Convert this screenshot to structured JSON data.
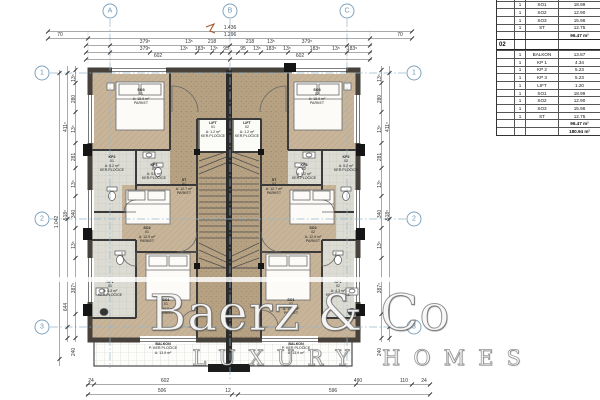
{
  "brand": {
    "name": "Baerz & Co",
    "tagline": "LUXURY HOMES"
  },
  "grid_bubbles": {
    "top": [
      "A",
      "B",
      "C"
    ],
    "left": [
      "1",
      "2",
      "3"
    ],
    "right": [
      "1",
      "2",
      "3"
    ]
  },
  "dimensions": {
    "top_total": "1.436",
    "top_row2": [
      "70",
      "1.296",
      "70"
    ],
    "top_row3": [
      "379⁵",
      "13⁵",
      "218",
      "218",
      "13⁵",
      "379⁵"
    ],
    "top_row4": [
      "379⁵",
      "13⁵",
      "183⁵",
      "13⁵",
      "95",
      "95",
      "13⁵",
      "183⁵",
      "13⁵",
      "183⁵",
      "13⁵",
      "183⁵"
    ],
    "top_row5": [
      "602",
      "602"
    ],
    "left_total": "1.042",
    "left_mid": [
      "411⁵",
      "518⁵",
      "644"
    ],
    "left_segments": [
      "13⁵",
      "280",
      "13⁵",
      "281",
      "13⁵",
      "340",
      "13⁵",
      "387⁵",
      "240"
    ],
    "right_mid": [
      "411⁵",
      "518⁵",
      "644"
    ],
    "right_segments": [
      "13⁵",
      "280",
      "13⁵",
      "281",
      "13⁵",
      "340",
      "13⁵",
      "387⁵",
      "240"
    ],
    "bottom_row1": [
      "24",
      "602",
      "490",
      "110",
      "24"
    ],
    "bottom_row2": [
      "506",
      "12",
      "596"
    ]
  },
  "rooms": {
    "so3_l": {
      "name": "SO3",
      "num": "01",
      "area": "A: 15.9 m²",
      "floor": "PARKET"
    },
    "so3_r": {
      "name": "SO3",
      "num": "02",
      "area": "A: 15.9 m²",
      "floor": "PARKET"
    },
    "kp2_l": {
      "name": "KP2",
      "num": "01",
      "area": "A: 5.2 m²",
      "floor": "KER.PLOČICE"
    },
    "kp2_r": {
      "name": "KP2",
      "num": "02",
      "area": "A: 5.2 m²",
      "floor": "KER.PLOČICE"
    },
    "kp3_l": {
      "name": "KP3",
      "num": "01",
      "area": "A: 5.2 m²",
      "floor": "KER.PLOČICE"
    },
    "kp3_r": {
      "name": "KP3",
      "num": "02",
      "area": "A: 5.2 m²",
      "floor": "KER.PLOČICE"
    },
    "so2_l": {
      "name": "SO2",
      "num": "01",
      "area": "A: 12.9 m²",
      "floor": "PARKET"
    },
    "so2_r": {
      "name": "SO2",
      "num": "02",
      "area": "A: 12.9 m²",
      "floor": "PARKET"
    },
    "st_l": {
      "name": "ST",
      "num": "01",
      "area": "A: 12.7 m²",
      "floor": "PARKET"
    },
    "st_r": {
      "name": "ST",
      "num": "02",
      "area": "A: 12.7 m²",
      "floor": "PARKET"
    },
    "lift_l": {
      "name": "LIFT",
      "num": "01",
      "area": "A: 1.2 m²",
      "floor": "KER.PLOČICE"
    },
    "lift_r": {
      "name": "LIFT",
      "num": "02",
      "area": "A: 1.2 m²",
      "floor": "KER.PLOČICE"
    },
    "kp1_l": {
      "name": "KP1",
      "num": "01",
      "area": "A: 4.3 m²",
      "floor": "KER.PLOČICE"
    },
    "kp1_r": {
      "name": "KP1",
      "num": "02",
      "area": "A: 4.3 m²",
      "floor": "KER.PLOČICE"
    },
    "so1_l": {
      "name": "SO1",
      "num": "01",
      "area": "A: 19.0 m²",
      "floor": "PARKET"
    },
    "so1_r": {
      "name": "SO1",
      "num": "02",
      "area": "A: 19.0 m²",
      "floor": "PARKET"
    },
    "balkon_l": {
      "name": "BALKON",
      "floor": "P: KER PLOČICE",
      "area": "A: 13.9 m²"
    },
    "balkon_r": {
      "name": "BALKON",
      "floor": "P: KER PLOČICE",
      "area": "A: 13.9 m²"
    }
  },
  "schedule": {
    "rows_01": [
      {
        "qty": "1",
        "name": "LIFT",
        "area": "1.20"
      },
      {
        "qty": "1",
        "name": "SO1",
        "area": "18.99"
      },
      {
        "qty": "1",
        "name": "SO2",
        "area": "12.90"
      },
      {
        "qty": "1",
        "name": "SO3",
        "area": "15.96"
      },
      {
        "qty": "1",
        "name": "ST",
        "area": "12.75"
      }
    ],
    "total_01": "96.47 m²",
    "section_label": "02",
    "rows_02": [
      {
        "qty": "1",
        "name": "BALKON",
        "area": "13.87"
      },
      {
        "qty": "1",
        "name": "KP 1",
        "area": "4.34"
      },
      {
        "qty": "1",
        "name": "KP 2",
        "area": "5.23"
      },
      {
        "qty": "1",
        "name": "KP 3",
        "area": "5.23"
      },
      {
        "qty": "1",
        "name": "LIFT",
        "area": "1.20"
      },
      {
        "qty": "1",
        "name": "SO1",
        "area": "18.99"
      },
      {
        "qty": "1",
        "name": "SO2",
        "area": "12.90"
      },
      {
        "qty": "1",
        "name": "SO3",
        "area": "15.96"
      },
      {
        "qty": "1",
        "name": "ST",
        "area": "12.75"
      }
    ],
    "total_02": "96.47 m²",
    "grand_total": "180.94 m²"
  }
}
